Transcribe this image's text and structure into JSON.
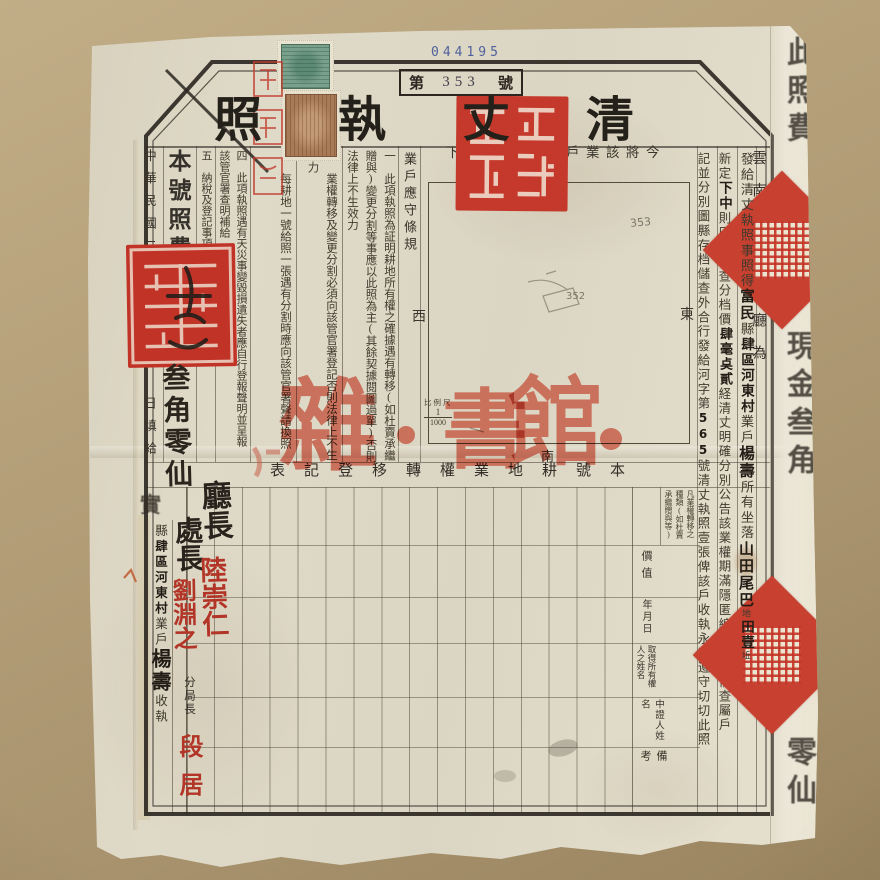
{
  "serial_number": "044195",
  "number_box": {
    "prefix": "第",
    "number": "353",
    "suffix": "號"
  },
  "title": "清丈執照",
  "org_column": "雲南省財政廳為",
  "issue_column": {
    "s0": "發給清丈執照事照得",
    "s1": "富民",
    "s2": "縣",
    "s3": "肆區河東村",
    "s4": "業戶",
    "s5": "楊壽",
    "s6": "所有坐落",
    "s7": "山田尾巴",
    "s8": "地",
    "s9": "田壹",
    "s10": "坵"
  },
  "assess_column": {
    "s0": "新定",
    "s1": "下中",
    "s2": "則田壹畝查分档價",
    "s3": "肆毫奌貳",
    "s4": "経清丈明確分別公告該業權期滿隱匿編造圖冊備查屬戶"
  },
  "closing_column": {
    "pre": "記並分別圖縣存档儲查外合行發給河字第",
    "number": "565",
    "post": "號清丈執照壹張俾該戶收執永遠遵守切切此照"
  },
  "map": {
    "caption": "今將該業戶耕地繪圖如下",
    "north": "北",
    "south": "南",
    "east": "東",
    "west": "西",
    "scale_label": "比例尺",
    "scale_numerator": "1",
    "scale_denominator": "1000",
    "pencil_number_1": "353",
    "pencil_number_2": "352"
  },
  "regulations": {
    "heading": "業戶應守條規",
    "item1_no": "一",
    "item1": "此項執照為証明耕地所有權之確據遇有轉移(如杜賣承繼贈與)變更分割等事應以此照為主(其餘契據閱圖過單)否則法律上不生效力",
    "item2_no": "二",
    "item2": "業權轉移及變更分割必須向該管官署登記否則法律上不生效力",
    "item3_no": "三",
    "item3": "每耕地一號給照一張遇有分割時應向該管官署聲請換照",
    "item4_no": "四",
    "item4": "此項執照遇有天災事變毀損遺失者應自行登報聲明並呈報該管官署查明補給",
    "item5_no": "五",
    "item5": "納稅及登記事項"
  },
  "fee": {
    "printed": "本號照費現金",
    "handwritten": "叁角零仙"
  },
  "date_line": "中華民國二十二年　月　日填給",
  "receipt": {
    "s0": "縣",
    "s1": "肆區河東村",
    "s2": "業戶",
    "s3": "楊壽",
    "s4": "收執"
  },
  "table": {
    "title": "本號耕地業權轉移登記表",
    "note": "凡業權轉移之種類(如杜賣承繼贈與等)",
    "header1": "價值",
    "header2": "年月日",
    "header3": "取得所有權人之姓名",
    "header4": "中證人姓名",
    "header5": "備考"
  },
  "signatures": {
    "role1": "廳長",
    "name1": "陸崇仁",
    "role2": "處長",
    "name2": "劉淵之",
    "role3": "分局長",
    "name3": "段居"
  },
  "overprint": {
    "c1": "雜",
    "c2": "書",
    "c3": "館"
  },
  "fold": {
    "g1": "此照費",
    "g2": "現金叁角",
    "g3": "零仙",
    "bleed_left": "實"
  },
  "colors": {
    "seal_red": "#c5392c",
    "signature_red": "#b23527",
    "overprint_red": "#c75f4a",
    "serial_blue": "#50619c",
    "stamp_green": "#79a08b",
    "stamp_brown": "#a87a56",
    "paper": "#ded8c6",
    "background": "#ab9671"
  }
}
